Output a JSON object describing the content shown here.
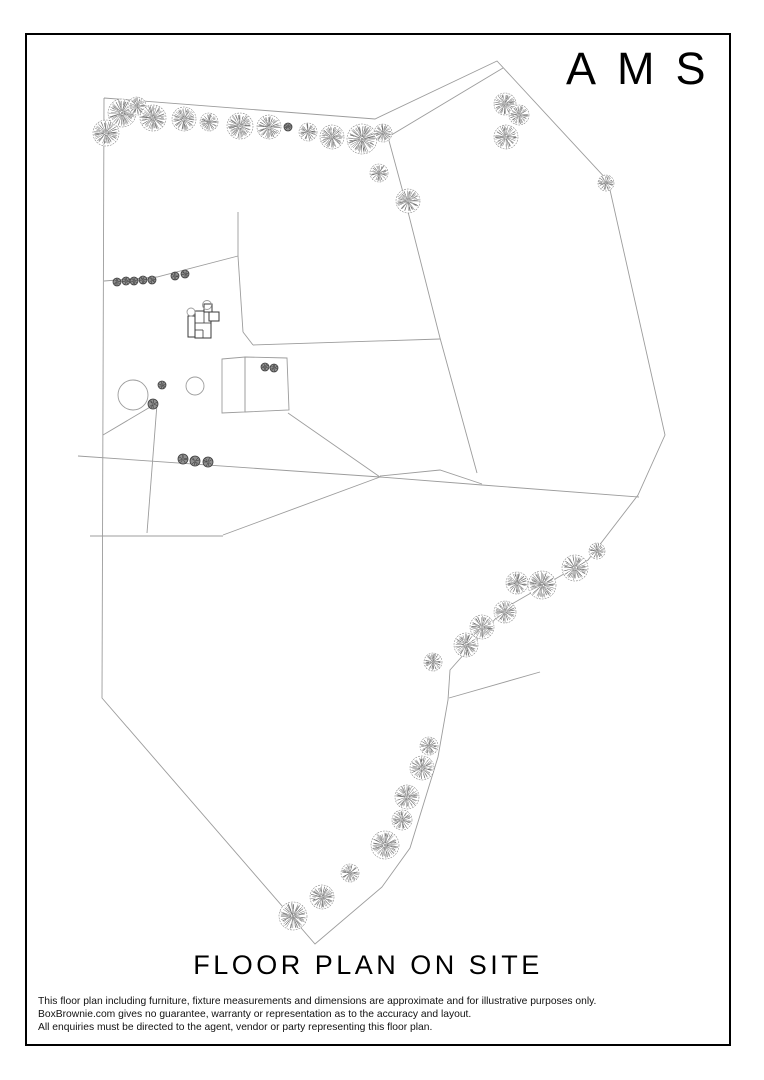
{
  "branding": {
    "logo": "AMS"
  },
  "title": "FLOOR PLAN ON SITE",
  "disclaimer": {
    "lines": [
      "This floor plan including furniture, fixture measurements and dimensions are approximate and for illustrative purposes only.",
      "BoxBrownie.com gives no guarantee, warranty or representation as to the accuracy and layout.",
      "All enquiries must be directed to the agent, vendor or party representing this floor plan."
    ]
  },
  "page": {
    "background": "#ffffff",
    "border_color": "#000000"
  },
  "plan": {
    "colors": {
      "line": "#9c9c9c",
      "tree_edge": "#7d7d7d",
      "tree_hatch": "#5a5a5a",
      "bush_fill": "#8f8f8f",
      "bush_edge": "#3c3c3c",
      "building": "#3a3a3a"
    },
    "boundary": [
      [
        104,
        98
      ],
      [
        375,
        119
      ],
      [
        497,
        61
      ],
      [
        608,
        181
      ],
      [
        665,
        435
      ],
      [
        638,
        495
      ],
      [
        588,
        560
      ],
      [
        505,
        608
      ],
      [
        450,
        670
      ],
      [
        448,
        700
      ],
      [
        438,
        757
      ],
      [
        410,
        848
      ],
      [
        382,
        887
      ],
      [
        315,
        944
      ],
      [
        102,
        698
      ],
      [
        104,
        98
      ]
    ],
    "internal_lines": [
      [
        [
          503,
          68
        ],
        [
          388,
          137
        ],
        [
          404,
          196
        ],
        [
          440,
          338
        ],
        [
          477,
          473
        ]
      ],
      [
        [
          253,
          345
        ],
        [
          440,
          339
        ]
      ],
      [
        [
          243,
          332
        ],
        [
          253,
          345
        ]
      ],
      [
        [
          238,
          212
        ],
        [
          238,
          256
        ],
        [
          243,
          332
        ]
      ],
      [
        [
          104,
          281
        ],
        [
          157,
          277
        ],
        [
          238,
          256
        ]
      ],
      [
        [
          78,
          456
        ],
        [
          380,
          477
        ],
        [
          482,
          485
        ],
        [
          639,
          497
        ]
      ],
      [
        [
          380,
          476
        ],
        [
          440,
          470
        ],
        [
          482,
          484
        ]
      ],
      [
        [
          380,
          477
        ],
        [
          223,
          535
        ]
      ],
      [
        [
          223,
          536
        ],
        [
          90,
          536
        ]
      ],
      [
        [
          147,
          533
        ],
        [
          157,
          404
        ]
      ],
      [
        [
          103,
          435
        ],
        [
          157,
          403
        ]
      ],
      [
        [
          288,
          413
        ],
        [
          380,
          477
        ]
      ],
      [
        [
          449,
          698
        ],
        [
          540,
          672
        ]
      ]
    ],
    "enclosures": [
      [
        [
          222,
          359
        ],
        [
          245,
          357
        ],
        [
          245,
          412
        ],
        [
          222,
          413
        ]
      ],
      [
        [
          245,
          357
        ],
        [
          287,
          358
        ],
        [
          289,
          410
        ],
        [
          245,
          412
        ]
      ]
    ],
    "ground_circles": [
      [
        133,
        395,
        15
      ],
      [
        195,
        386,
        9
      ]
    ],
    "trees": [
      [
        106,
        133,
        13
      ],
      [
        122,
        113,
        14
      ],
      [
        137,
        106,
        9
      ],
      [
        153,
        118,
        13
      ],
      [
        184,
        119,
        12
      ],
      [
        209,
        122,
        9
      ],
      [
        240,
        126,
        13
      ],
      [
        269,
        127,
        12
      ],
      [
        308,
        132,
        9
      ],
      [
        332,
        137,
        12
      ],
      [
        362,
        139,
        15
      ],
      [
        383,
        133,
        9
      ],
      [
        379,
        173,
        9
      ],
      [
        408,
        201,
        12
      ],
      [
        505,
        104,
        11
      ],
      [
        519,
        115,
        10
      ],
      [
        506,
        137,
        12
      ],
      [
        606,
        183,
        8
      ],
      [
        433,
        662,
        9
      ],
      [
        466,
        645,
        12
      ],
      [
        482,
        627,
        12
      ],
      [
        505,
        612,
        11
      ],
      [
        517,
        583,
        11
      ],
      [
        542,
        585,
        14
      ],
      [
        575,
        568,
        13
      ],
      [
        597,
        551,
        8
      ],
      [
        429,
        746,
        9
      ],
      [
        422,
        768,
        12
      ],
      [
        407,
        797,
        12
      ],
      [
        402,
        820,
        10
      ],
      [
        385,
        845,
        14
      ],
      [
        350,
        873,
        9
      ],
      [
        322,
        897,
        12
      ],
      [
        293,
        916,
        14
      ]
    ],
    "bushes": [
      [
        288,
        127,
        4
      ],
      [
        117,
        282,
        4
      ],
      [
        126,
        281,
        4
      ],
      [
        134,
        281,
        4
      ],
      [
        143,
        280,
        4
      ],
      [
        152,
        280,
        4
      ],
      [
        175,
        276,
        4
      ],
      [
        185,
        274,
        4
      ],
      [
        162,
        385,
        4
      ],
      [
        153,
        404,
        5
      ],
      [
        265,
        367,
        4
      ],
      [
        274,
        368,
        4
      ],
      [
        183,
        459,
        5
      ],
      [
        195,
        461,
        5
      ],
      [
        208,
        462,
        5
      ]
    ],
    "building": {
      "rects": [
        [
          188,
          316,
          9,
          21
        ],
        [
          195,
          311,
          16,
          27
        ],
        [
          209,
          312,
          10,
          9
        ],
        [
          204,
          304,
          8,
          8
        ]
      ],
      "lines": [
        [
          [
            195,
            323
          ],
          [
            211,
            323
          ]
        ],
        [
          [
            204,
            311
          ],
          [
            204,
            323
          ]
        ],
        [
          [
            195,
            330
          ],
          [
            203,
            330
          ]
        ],
        [
          [
            203,
            330
          ],
          [
            203,
            338
          ]
        ]
      ],
      "circles": [
        [
          191,
          312,
          4
        ],
        [
          207,
          305,
          4.5
        ]
      ]
    }
  }
}
